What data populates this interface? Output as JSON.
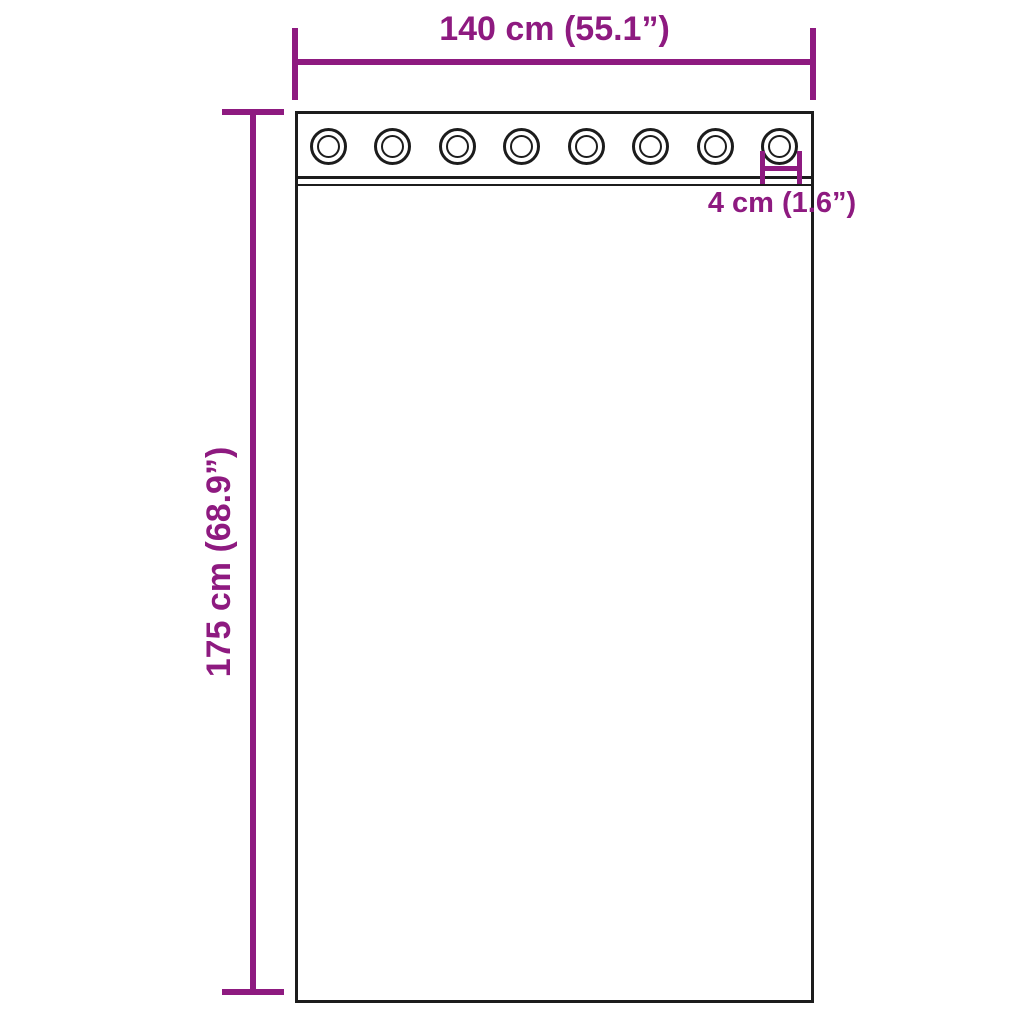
{
  "diagram": {
    "type": "product-dimension-diagram",
    "subject": "sheer curtain panel with grommets",
    "labels": {
      "width": "140 cm (55.1”)",
      "height": "175 cm (68.9”)",
      "grommet": "4 cm (1.6”)"
    },
    "grommets": {
      "count": 8
    },
    "colors": {
      "dimension": "#8e1a80",
      "outline": "#1c1c1c",
      "background": "#ffffff"
    }
  }
}
